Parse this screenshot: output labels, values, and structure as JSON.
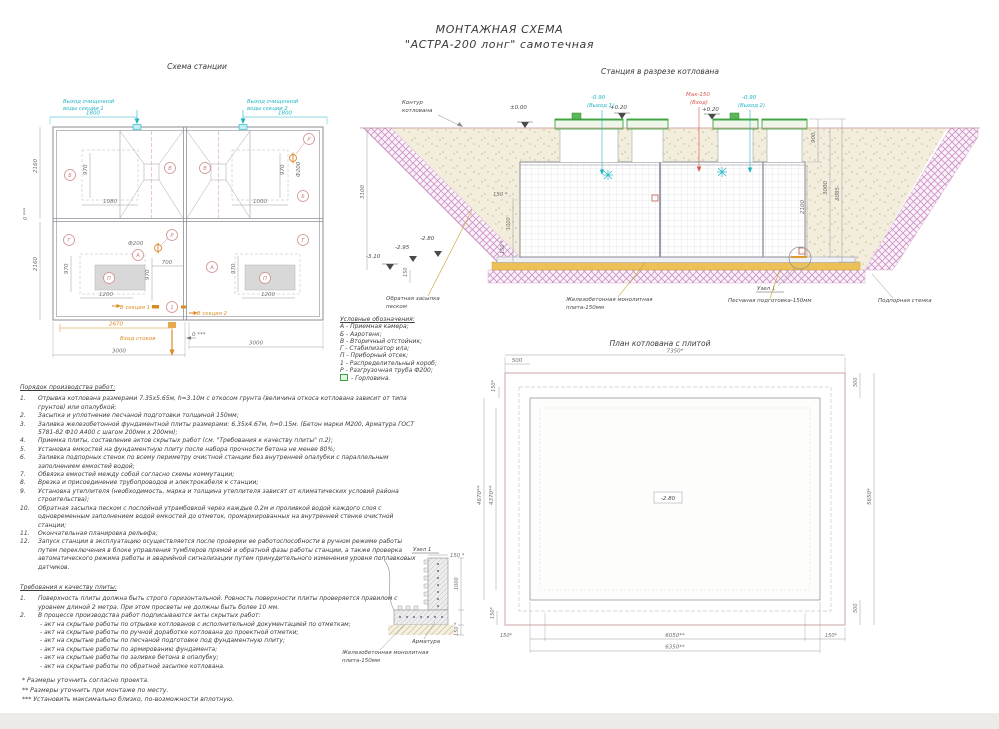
{
  "page": {
    "title_line1": "МОНТАЖНАЯ СХЕМА",
    "title_line2": "\"АСТРА-200 лонг\" самотечная"
  },
  "colors": {
    "teal": "#21b3c4",
    "orange": "#dd8b21",
    "green": "#3fa33f",
    "purple_hatch": "#cd8fc5",
    "red": "#d9574b",
    "sand": "#ecc258"
  },
  "station_plan": {
    "title": "Схема станции",
    "d1800": "1800",
    "d2160": "2160",
    "d970": "970",
    "d1080": "1080",
    "d1000": "1000",
    "d700": "700",
    "d1200": "1200",
    "d3000": "3000",
    "d2670": "2670",
    "phi200": "Ф200",
    "zero": "0 ***",
    "outlet_l1": "Выход очищенной",
    "outlet1_l2": "воды секции 1",
    "outlet2_l2": "воды секции 2",
    "inlet": "Вход стоков",
    "sec1": "В секция 1",
    "sec2": "В секция 2",
    "mA": "А",
    "mB": "Б",
    "mV": "В",
    "mG": "Г",
    "mP": "П",
    "mR": "Р",
    "m1": "1"
  },
  "cross_section": {
    "title": "Станция в разрезе котлована",
    "contour_l1": "Контур",
    "contour_l2": "котлована",
    "lvl0": "±0.00",
    "lvl020": "+0.20",
    "lvl090": "-0.90",
    "out1": "(Выход 1)",
    "out2": "(Выход 2)",
    "max150": "Max-150",
    "inlet": "(Вход)",
    "m310": "-3.10",
    "m295": "-2.95",
    "m280": "-2.80",
    "d3100": "3100",
    "d150": "150",
    "d150s": "150 *",
    "d1000": "1000",
    "d900": "900",
    "d3000": "3000",
    "d3085": "3085",
    "d2100": "2100",
    "backfill_l1": "Обратная засыпка",
    "backfill_l2": "песком",
    "slab_l1": "Железобетонная монолитная",
    "slab_l2": "плита-150мм",
    "sand": "Песчаная подготовка-150мм",
    "node": "Узел 1",
    "wall": "Подпорная стенка"
  },
  "pit_plan": {
    "title": "План котлована с плитой",
    "d7350": "7350*",
    "d500": "500",
    "d150": "150*",
    "d4670": "4670**",
    "d4370": "4370**",
    "d5650": "5650*",
    "d6050": "6050**",
    "d6350": "6350**",
    "lvl280": "-2.80"
  },
  "node_detail": {
    "title": "Узел 1",
    "d150s": "150 *",
    "d1000": "1000",
    "rebar": "Арматура",
    "slab_l1": "Железобетонная монолитная",
    "slab_l2": "плита-150мм"
  },
  "legend": {
    "title": "Условные обозначения:",
    "items": [
      "А - Приемная камера;",
      "Б - Аэротенк;",
      "В - Вторичный отстойник;",
      "Г - Стабилизатор ила;",
      "П - Приборный отсек;",
      "1 - Распределительный короб;",
      "Р - Разгрузочная труба Ф200;"
    ],
    "gorlovina_label": "- Горловина."
  },
  "work_order": {
    "title": "Порядок производства работ:",
    "items": [
      {
        "num": "1.",
        "text": "Отрывка котлована размерами 7.35x5.65м, h=3.10м с откосом грунта (величина откоса котлована зависит от типа грунтов) или опалубкой;"
      },
      {
        "num": "2.",
        "text": "Засыпка и уплотнение песчаной подготовки толщиной 150мм;"
      },
      {
        "num": "3.",
        "text": "Заливка железобетонной фундаментной плиты размерами: 6.35x4.67м, h=0.15м. (Бетон марки М200, Арматура ГОСТ 5781-82 Ф10 А400 с шагом 200мм x 200мм);"
      },
      {
        "num": "4.",
        "text": "Приемка плиты, составление актов скрытых работ (см. \"Требования к качеству плиты\" п.2);"
      },
      {
        "num": "5.",
        "text": "Установка емкостей на фундаментную плиту после набора прочности бетона не менее 80%;"
      },
      {
        "num": "6.",
        "text": "Заливка подпорных стенок по всему периметру очистной станции без внутренней опалубки с параллельным заполнением емкостей водой;"
      },
      {
        "num": "7.",
        "text": "Обвязка емкостей между собой согласно схемы коммутации;"
      },
      {
        "num": "8.",
        "text": "Врезка и присоединение трубопроводов и электрокабеля к станции;"
      },
      {
        "num": "9.",
        "text": "Установка утеплителя (необходимость, марка и толщина утеплителя зависят от климатических условий района строительства);"
      },
      {
        "num": "10.",
        "text": "Обратная засыпка песком с послойной утрамбовкой через каждые 0.2м и проливкой водой каждого слоя с одновременным заполнением водой емкостей до отметок, промаркированных на внутренней стенке очистной станции;"
      },
      {
        "num": "11.",
        "text": "Окончательная планировка рельефа;"
      },
      {
        "num": "12.",
        "text": "Запуск станции в эксплуатацию осуществляется после проверки ее работоспособности в ручном режиме работы путем переключения в блоке управления тумблеров прямой и обратной фазы работы станции, а также проверка автоматического режима работы и аварийной сигнализации путем принудительного изменения уровня поплавковых датчиков."
      }
    ]
  },
  "requirements": {
    "title": "Требования к качеству плиты:",
    "items": [
      {
        "num": "1.",
        "text": "Поверхность плиты должна быть строго горизонтальной. Ровность поверхности плиты проверяется правилом с уровнем длиной 2 метра. При этом просветы не должны быть более 10 мм."
      },
      {
        "num": "2.",
        "text": "В процессе производства работ подписываются акты скрытых работ:"
      }
    ],
    "acts": [
      "- акт на скрытые работы по отрывке котлованов с исполнительной документацией по отметкам;",
      "- акт на скрытые работы по ручной доработке котлована до проектной отметки;",
      "- акт на скрытые работы по песчаной подготовке под фундаментную плиту;",
      "- акт на скрытые работы по армированию фундамента;",
      "- акт на скрытые работы по заливке бетона в опалубку;",
      "- акт на скрытые работы по обратной засыпке котлована."
    ]
  },
  "notes": [
    "* Размеры уточнить согласно проекта.",
    "** Размеры уточнить при монтаже по месту.",
    "*** Установить максимально близко, по-возможности вплотную."
  ]
}
